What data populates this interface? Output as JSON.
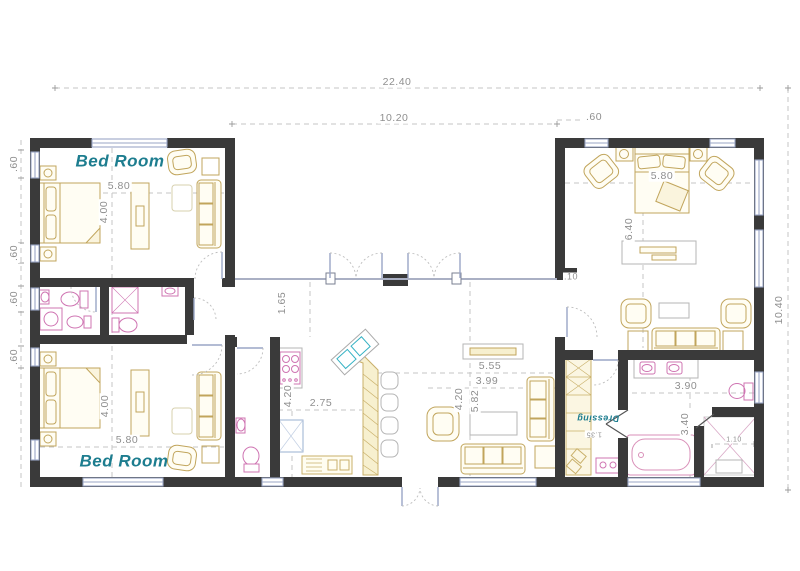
{
  "overall": {
    "total_width": "22.40",
    "center_width": "10.20",
    "top_offset": ".60",
    "right_height": "10.40",
    "left_windows": [
      ".60",
      ".60",
      ".60",
      ".60"
    ]
  },
  "rooms": {
    "bedroom1": {
      "label": "Bed Room",
      "width": "5.80",
      "height": "4.00"
    },
    "bedroom2": {
      "label": "Bed Room",
      "width": "5.80",
      "height": "4.00"
    },
    "master": {
      "width": "5.80",
      "height": "6.40",
      "wall_offset": ".10"
    },
    "kitchen": {
      "width": "2.75",
      "height": "4.20"
    },
    "corridor": {
      "height": "1.65"
    },
    "living": {
      "width_a": "5.55",
      "width_b": "3.99",
      "height_a": "4.20",
      "height_b": "5.82"
    },
    "bathroom": {
      "width": "3.90",
      "height": "3.40",
      "shower_width": "1.10"
    },
    "dressing": {
      "label": "Dressing",
      "depth": "1.35"
    }
  },
  "colors": {
    "wall": "#3a3a3a",
    "furniture": "#c1a55c",
    "fixture": "#cf74b2",
    "sink": "#35b2c4",
    "window": "#9aa6c6",
    "room_label": "#1d7d8f",
    "dimension_text": "#8f8f8f"
  }
}
